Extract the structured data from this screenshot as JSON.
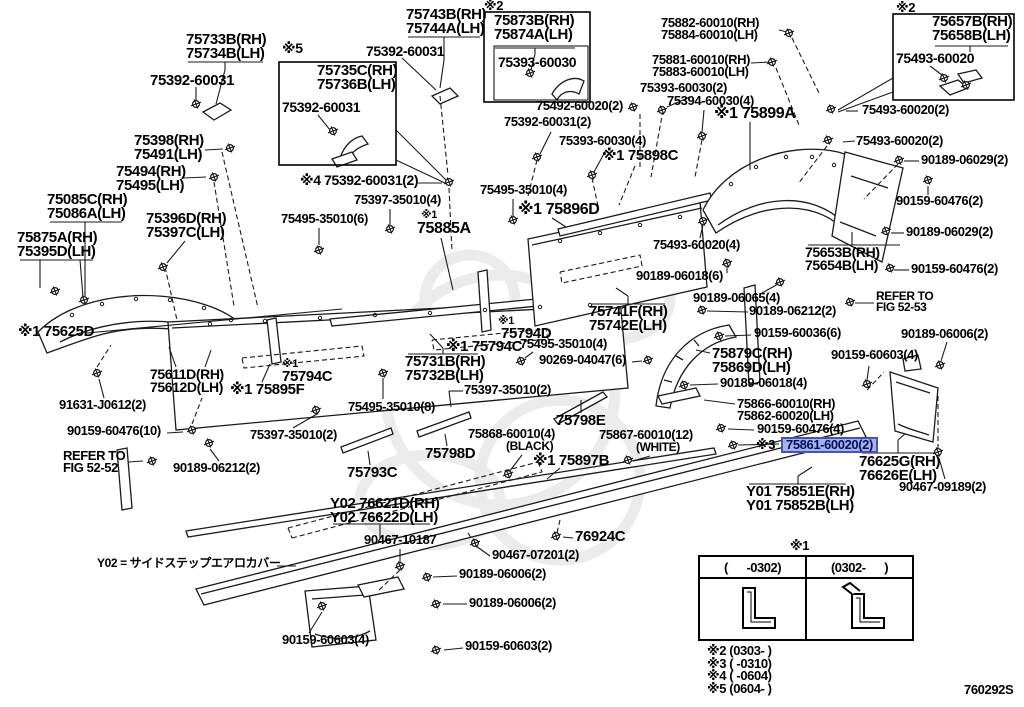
{
  "page": {
    "width": 1024,
    "height": 707,
    "background": "#ffffff",
    "figure_code": "760292S"
  },
  "highlight": {
    "fill": "#a9b1e8",
    "border": "#4553b4",
    "text_color": "#001060"
  },
  "table": {
    "marker": "※1",
    "columns": [
      "(      -0302)",
      "(0302-      )"
    ]
  },
  "footnotes": [
    "※2 (0303-      )",
    "※3 (      -0310)",
    "※4 (      -0604)",
    "※5 (0604-      )"
  ],
  "labels": [
    {
      "lines": [
        "75733B(RH)",
        "75734B(LH)"
      ],
      "x": 186,
      "y": 33,
      "size": 15
    },
    {
      "text": "75392-60031",
      "x": 150,
      "y": 74,
      "size": 15
    },
    {
      "text": "※5",
      "x": 282,
      "y": 42,
      "size": 14,
      "name": "ref-marker-5",
      "interactable": false
    },
    {
      "lines": [
        "75735C(RH)",
        "75736B(LH)"
      ],
      "x": 317,
      "y": 64,
      "size": 15
    },
    {
      "text": "75392-60031",
      "x": 282,
      "y": 101,
      "size": 14
    },
    {
      "lines": [
        "75743B(RH)",
        "75744A(LH)"
      ],
      "x": 406,
      "y": 8,
      "size": 15
    },
    {
      "text": "75392-60031",
      "x": 366,
      "y": 45,
      "size": 14
    },
    {
      "text": "※2",
      "x": 484,
      "y": 0,
      "size": 13,
      "name": "ref-marker-2",
      "interactable": false
    },
    {
      "lines": [
        "75873B(RH)",
        "75874A(LH)"
      ],
      "x": 494,
      "y": 14,
      "size": 15
    },
    {
      "text": "75393-60030",
      "x": 498,
      "y": 56,
      "size": 14
    },
    {
      "text": "75492-60020(2)",
      "x": 536,
      "y": 100,
      "size": 13
    },
    {
      "text": "75392-60031(2)",
      "x": 504,
      "y": 116,
      "size": 13
    },
    {
      "text": "75393-60030(4)",
      "x": 559,
      "y": 135,
      "size": 13
    },
    {
      "text": "※1 75898C",
      "x": 602,
      "y": 149,
      "size": 15
    },
    {
      "lines": [
        "75882-60010(RH)",
        "75884-60010(LH)"
      ],
      "x": 661,
      "y": 17,
      "size": 13
    },
    {
      "lines": [
        "75881-60010(RH)",
        "75883-60010(LH)"
      ],
      "x": 652,
      "y": 54,
      "size": 13
    },
    {
      "text": "75393-60030(2)",
      "x": 640,
      "y": 82,
      "size": 13
    },
    {
      "text": "75394-60030(4)",
      "x": 667,
      "y": 95,
      "size": 13
    },
    {
      "text": "※1 75899A",
      "x": 714,
      "y": 106,
      "size": 16
    },
    {
      "text": "※2",
      "x": 896,
      "y": 2,
      "size": 13,
      "name": "ref-marker-2",
      "interactable": false
    },
    {
      "lines": [
        "75657B(RH)",
        "75658B(LH)"
      ],
      "x": 932,
      "y": 15,
      "size": 15
    },
    {
      "text": "75493-60020",
      "x": 896,
      "y": 52,
      "size": 14
    },
    {
      "text": "75493-60020(2)",
      "x": 862,
      "y": 104,
      "size": 13
    },
    {
      "text": "75493-60020(2)",
      "x": 856,
      "y": 135,
      "size": 13
    },
    {
      "text": "90189-06029(2)",
      "x": 921,
      "y": 154,
      "size": 13
    },
    {
      "text": "90159-60476(2)",
      "x": 896,
      "y": 195,
      "size": 13
    },
    {
      "text": "90189-06029(2)",
      "x": 906,
      "y": 226,
      "size": 13
    },
    {
      "text": "90159-60476(2)",
      "x": 911,
      "y": 263,
      "size": 13
    },
    {
      "lines": [
        "75653B(RH)",
        "75654B(LH)"
      ],
      "x": 805,
      "y": 246,
      "size": 14
    },
    {
      "lines": [
        "REFER TO",
        "FIG 52-53"
      ],
      "x": 876,
      "y": 291,
      "size": 12,
      "name": "refer-to-fig-52-53",
      "interactable": false
    },
    {
      "text": "90189-06006(2)",
      "x": 901,
      "y": 328,
      "size": 13
    },
    {
      "text": "90159-60603(4)",
      "x": 831,
      "y": 349,
      "size": 13
    },
    {
      "lines": [
        "75398(RH)",
        "75491(LH)"
      ],
      "x": 134,
      "y": 134,
      "size": 15
    },
    {
      "lines": [
        "75494(RH)",
        "75495(LH)"
      ],
      "x": 116,
      "y": 165,
      "size": 15
    },
    {
      "lines": [
        "75085C(RH)",
        "75086A(LH)"
      ],
      "x": 47,
      "y": 193,
      "size": 15
    },
    {
      "lines": [
        "75875A(RH)",
        "75395D(LH)"
      ],
      "x": 17,
      "y": 231,
      "size": 15
    },
    {
      "lines": [
        "75396D(RH)",
        "75397C(LH)"
      ],
      "x": 146,
      "y": 212,
      "size": 15
    },
    {
      "text": "※1 75625D",
      "x": 18,
      "y": 325,
      "size": 15
    },
    {
      "lines": [
        "75611D(RH)",
        "75612D(LH)"
      ],
      "x": 150,
      "y": 368,
      "size": 14
    },
    {
      "text": "※1 75895F",
      "x": 230,
      "y": 383,
      "size": 15
    },
    {
      "text": "91631-J0612(2)",
      "x": 59,
      "y": 399,
      "size": 13
    },
    {
      "text": "90159-60476(10)",
      "x": 67,
      "y": 425,
      "size": 13
    },
    {
      "lines": [
        "REFER TO",
        "FIG 52-52"
      ],
      "x": 63,
      "y": 450,
      "size": 13,
      "name": "refer-to-fig-52-52",
      "interactable": false
    },
    {
      "text": "90189-06212(2)",
      "x": 173,
      "y": 462,
      "size": 13
    },
    {
      "text": "※4 75392-60031(2)",
      "x": 300,
      "y": 174,
      "size": 14
    },
    {
      "text": "75397-35010(4)",
      "x": 354,
      "y": 194,
      "size": 13
    },
    {
      "text": "75495-35010(6)",
      "x": 281,
      "y": 213,
      "size": 13
    },
    {
      "text": "75495-35010(4)",
      "x": 480,
      "y": 184,
      "size": 13
    },
    {
      "text": "※1 75896D",
      "x": 518,
      "y": 202,
      "size": 16
    },
    {
      "text": "※1",
      "x": 421,
      "y": 210,
      "size": 11,
      "name": "ref-marker-1",
      "interactable": false
    },
    {
      "text": "75885A",
      "x": 417,
      "y": 221,
      "size": 16
    },
    {
      "text": "75495-35010(4)",
      "x": 520,
      "y": 338,
      "size": 13
    },
    {
      "text": "90269-04047(6)",
      "x": 539,
      "y": 354,
      "size": 13
    },
    {
      "text": "※1",
      "x": 498,
      "y": 316,
      "size": 11,
      "name": "ref-marker-1",
      "interactable": false
    },
    {
      "text": "75794D",
      "x": 501,
      "y": 327,
      "size": 15
    },
    {
      "text": "※1 75794C",
      "x": 446,
      "y": 340,
      "size": 15
    },
    {
      "text": "※1",
      "x": 282,
      "y": 359,
      "size": 11,
      "name": "ref-marker-1",
      "interactable": false
    },
    {
      "text": "75794C",
      "x": 282,
      "y": 370,
      "size": 15
    },
    {
      "lines": [
        "75731B(RH)",
        "75732B(LH)"
      ],
      "x": 405,
      "y": 355,
      "size": 15
    },
    {
      "text": "75397-35010(2)",
      "x": 464,
      "y": 384,
      "size": 13
    },
    {
      "text": "75495-35010(8)",
      "x": 348,
      "y": 401,
      "size": 13
    },
    {
      "text": "75397-35010(2)",
      "x": 250,
      "y": 429,
      "size": 13
    },
    {
      "text": "75793C",
      "x": 347,
      "y": 466,
      "size": 15
    },
    {
      "text": "75798D",
      "x": 425,
      "y": 447,
      "size": 15
    },
    {
      "text": "75798E",
      "x": 556,
      "y": 414,
      "size": 15
    },
    {
      "text": "75868-60010(4)",
      "x": 468,
      "y": 428,
      "size": 13
    },
    {
      "text": "(BLACK)",
      "x": 506,
      "y": 441,
      "size": 12
    },
    {
      "text": "75867-60010(12)",
      "x": 599,
      "y": 429,
      "size": 13
    },
    {
      "text": "(WHITE)",
      "x": 636,
      "y": 442,
      "size": 12
    },
    {
      "text": "※1 75897B",
      "x": 533,
      "y": 454,
      "size": 15
    },
    {
      "lines": [
        "75741F(RH)",
        "75742E(LH)"
      ],
      "x": 589,
      "y": 305,
      "size": 15
    },
    {
      "text": "90189-06018(6)",
      "x": 636,
      "y": 270,
      "size": 13
    },
    {
      "text": "75493-60020(4)",
      "x": 653,
      "y": 239,
      "size": 13
    },
    {
      "text": "90189-06065(4)",
      "x": 693,
      "y": 292,
      "size": 13
    },
    {
      "text": "90189-06212(2)",
      "x": 749,
      "y": 305,
      "size": 13
    },
    {
      "text": "90159-60036(6)",
      "x": 754,
      "y": 327,
      "size": 13
    },
    {
      "lines": [
        "75879C(RH)",
        "75869D(LH)"
      ],
      "x": 712,
      "y": 347,
      "size": 15
    },
    {
      "text": "90189-06018(4)",
      "x": 720,
      "y": 377,
      "size": 13
    },
    {
      "lines": [
        "75866-60010(RH)",
        "75862-60020(LH)"
      ],
      "x": 737,
      "y": 398,
      "size": 13
    },
    {
      "text": "90159-60476(4)",
      "x": 757,
      "y": 423,
      "size": 13
    },
    {
      "text": "※3",
      "x": 756,
      "y": 439,
      "size": 13,
      "name": "ref-marker-3",
      "interactable": false
    },
    {
      "text": "75861-60020(2)",
      "x": 781,
      "y": 437,
      "size": 13,
      "highlight": true,
      "name": "selected-part-number"
    },
    {
      "lines": [
        "76625G(RH)",
        "76626E(LH)"
      ],
      "x": 859,
      "y": 455,
      "size": 15
    },
    {
      "text": "90467-09189(2)",
      "x": 899,
      "y": 481,
      "size": 13
    },
    {
      "lines": [
        "Y01 75851E(RH)",
        "Y01 75852B(LH)"
      ],
      "x": 746,
      "y": 485,
      "size": 15
    },
    {
      "lines": [
        "Y02 76621D(RH)",
        "Y02 76622D(LH)"
      ],
      "x": 330,
      "y": 497,
      "size": 15
    },
    {
      "text": "90467-10187",
      "x": 364,
      "y": 534,
      "size": 13
    },
    {
      "text": "76924C",
      "x": 575,
      "y": 530,
      "size": 15
    },
    {
      "text": "90467-07201(2)",
      "x": 492,
      "y": 549,
      "size": 13
    },
    {
      "text": "90189-06006(2)",
      "x": 459,
      "y": 568,
      "size": 13
    },
    {
      "text": "90189-06006(2)",
      "x": 469,
      "y": 597,
      "size": 13
    },
    {
      "text": "90159-60603(2)",
      "x": 465,
      "y": 640,
      "size": 13
    },
    {
      "text": "90159-60603(4)",
      "x": 282,
      "y": 634,
      "size": 13
    },
    {
      "text": "Y02 = サイドステップエアロカバー",
      "x": 97,
      "y": 558,
      "size": 12,
      "name": "y02-legend-note",
      "interactable": false
    },
    {
      "text": "760292S",
      "x": 964,
      "y": 684,
      "size": 13,
      "name": "figure-code",
      "interactable": false
    }
  ]
}
